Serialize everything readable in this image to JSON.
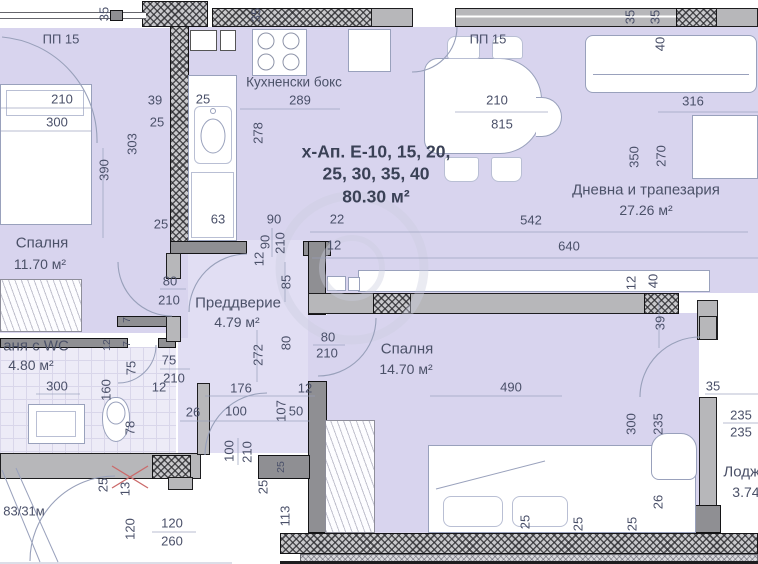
{
  "plan": {
    "title_block": {
      "x": 376,
      "lines": [
        {
          "t": "х-Ап. Е-10, 15, 20,",
          "y": 152
        },
        {
          "t": "25, 30, 35, 40",
          "y": 174
        },
        {
          "t": "80.30 м²",
          "y": 197
        }
      ]
    },
    "rooms": [
      {
        "name": "Спалня",
        "area": "11.70 м²",
        "nx": 42,
        "ny": 243,
        "ax": 40,
        "ay": 264
      },
      {
        "name": "Кухненски бокс",
        "area": null,
        "nx": 294,
        "ny": 82,
        "ns": 13.5
      },
      {
        "name": "Дневна и трапезария",
        "area": "27.26 м²",
        "nx": 646,
        "ny": 190,
        "ax": 646,
        "ay": 210
      },
      {
        "name": "Преддверие",
        "area": "4.79 м²",
        "nx": 238,
        "ny": 303,
        "ax": 237,
        "ay": 322
      },
      {
        "name": "аня с WC",
        "area": "4.80 м²",
        "nx": 36,
        "ny": 346,
        "ax": 31,
        "ay": 365
      },
      {
        "name": "Спалня",
        "area": "14.70 м²",
        "nx": 407,
        "ny": 349,
        "ax": 406,
        "ay": 369
      },
      {
        "name": "Лоджия",
        "area": "3.74 м²",
        "nx": 750,
        "ny": 472,
        "ax": 755,
        "ay": 492
      }
    ],
    "dimension_labels": [
      {
        "t": "35",
        "x": 104,
        "y": 14,
        "v": 1
      },
      {
        "t": "ПП 15",
        "x": 61,
        "y": 39,
        "s": 13
      },
      {
        "t": "210",
        "x": 62,
        "y": 99
      },
      {
        "t": "300",
        "x": 57,
        "y": 122
      },
      {
        "t": "390",
        "x": 104,
        "y": 170,
        "v": 1
      },
      {
        "t": "303",
        "x": 132,
        "y": 144,
        "v": 1
      },
      {
        "t": "39",
        "x": 155,
        "y": 100
      },
      {
        "t": "25",
        "x": 157,
        "y": 122
      },
      {
        "t": "25",
        "x": 203,
        "y": 99
      },
      {
        "t": "35",
        "x": 256,
        "y": 15,
        "v": 1
      },
      {
        "t": "289",
        "x": 300,
        "y": 100
      },
      {
        "t": "278",
        "x": 258,
        "y": 133,
        "v": 1
      },
      {
        "t": "25",
        "x": 161,
        "y": 224
      },
      {
        "t": "63",
        "x": 218,
        "y": 219
      },
      {
        "t": "90",
        "x": 274,
        "y": 219
      },
      {
        "t": "22",
        "x": 337,
        "y": 219
      },
      {
        "t": "90",
        "x": 265,
        "y": 242,
        "v": 1
      },
      {
        "t": "210",
        "x": 280,
        "y": 243,
        "v": 1
      },
      {
        "t": "12",
        "x": 334,
        "y": 245
      },
      {
        "t": "12",
        "x": 259,
        "y": 259,
        "v": 1
      },
      {
        "t": "85",
        "x": 286,
        "y": 282,
        "v": 1
      },
      {
        "t": "80",
        "x": 286,
        "y": 343,
        "v": 1
      },
      {
        "t": "272",
        "x": 258,
        "y": 355,
        "v": 1
      },
      {
        "t": "ПП 15",
        "x": 488,
        "y": 39,
        "s": 13
      },
      {
        "t": "210",
        "x": 497,
        "y": 100
      },
      {
        "t": "815",
        "x": 502,
        "y": 124
      },
      {
        "t": "35",
        "x": 630,
        "y": 17,
        "v": 1
      },
      {
        "t": "35",
        "x": 655,
        "y": 17,
        "v": 1
      },
      {
        "t": "40",
        "x": 660,
        "y": 44,
        "v": 1
      },
      {
        "t": "316",
        "x": 693,
        "y": 101
      },
      {
        "t": "350",
        "x": 634,
        "y": 157,
        "v": 1
      },
      {
        "t": "270",
        "x": 661,
        "y": 156,
        "v": 1
      },
      {
        "t": "542",
        "x": 531,
        "y": 220
      },
      {
        "t": "640",
        "x": 569,
        "y": 246
      },
      {
        "t": "80",
        "x": 170,
        "y": 281
      },
      {
        "t": "210",
        "x": 169,
        "y": 300
      },
      {
        "t": "7",
        "x": 127,
        "y": 320,
        "v": 1,
        "s": 10.5
      },
      {
        "t": "12",
        "x": 107,
        "y": 345,
        "v": 1,
        "s": 10.5
      },
      {
        "t": "7",
        "x": 127,
        "y": 344,
        "v": 1,
        "s": 10.5
      },
      {
        "t": "75",
        "x": 131,
        "y": 368,
        "v": 1
      },
      {
        "t": "160",
        "x": 106,
        "y": 390,
        "v": 1
      },
      {
        "t": "78",
        "x": 130,
        "y": 428,
        "v": 1
      },
      {
        "t": "75",
        "x": 169,
        "y": 360
      },
      {
        "t": "210",
        "x": 174,
        "y": 378
      },
      {
        "t": "12",
        "x": 159,
        "y": 387
      },
      {
        "t": "300",
        "x": 57,
        "y": 386
      },
      {
        "t": "80",
        "x": 328,
        "y": 337
      },
      {
        "t": "210",
        "x": 327,
        "y": 353
      },
      {
        "t": "12",
        "x": 631,
        "y": 283,
        "v": 1
      },
      {
        "t": "40",
        "x": 653,
        "y": 281,
        "v": 1
      },
      {
        "t": "39",
        "x": 660,
        "y": 323,
        "v": 1
      },
      {
        "t": "490",
        "x": 511,
        "y": 387
      },
      {
        "t": "176",
        "x": 241,
        "y": 388
      },
      {
        "t": "12",
        "x": 305,
        "y": 388
      },
      {
        "t": "26",
        "x": 193,
        "y": 412
      },
      {
        "t": "100",
        "x": 236,
        "y": 411
      },
      {
        "t": "50",
        "x": 296,
        "y": 411
      },
      {
        "t": "107",
        "x": 281,
        "y": 411,
        "v": 1
      },
      {
        "t": "100",
        "x": 229,
        "y": 451,
        "v": 1
      },
      {
        "t": "210",
        "x": 247,
        "y": 452,
        "v": 1
      },
      {
        "t": "25",
        "x": 281,
        "y": 467,
        "v": 1,
        "s": 10.5
      },
      {
        "t": "25",
        "x": 263,
        "y": 487,
        "v": 1
      },
      {
        "t": "113",
        "x": 285,
        "y": 516,
        "v": 1
      },
      {
        "t": "25",
        "x": 103,
        "y": 485,
        "v": 1
      },
      {
        "t": "13",
        "x": 125,
        "y": 489,
        "v": 1
      },
      {
        "t": "120",
        "x": 130,
        "y": 529,
        "v": 1
      },
      {
        "t": "120",
        "x": 172,
        "y": 523
      },
      {
        "t": "260",
        "x": 172,
        "y": 541
      },
      {
        "t": "83/31м",
        "x": 24,
        "y": 511,
        "s": 13
      },
      {
        "t": "35",
        "x": 713,
        "y": 386
      },
      {
        "t": "235",
        "x": 741,
        "y": 415
      },
      {
        "t": "235",
        "x": 741,
        "y": 432
      },
      {
        "t": "300",
        "x": 631,
        "y": 424,
        "v": 1
      },
      {
        "t": "235",
        "x": 658,
        "y": 424,
        "v": 1
      },
      {
        "t": "26",
        "x": 658,
        "y": 502,
        "v": 1
      },
      {
        "t": "25",
        "x": 525,
        "y": 522,
        "v": 1
      },
      {
        "t": "25",
        "x": 578,
        "y": 524,
        "v": 1
      },
      {
        "t": "25",
        "x": 632,
        "y": 524,
        "v": 1
      }
    ],
    "colors": {
      "floor": "#d8d4ee",
      "floor_light": "#e1def3",
      "wall_dark": "#8f8f93",
      "wall_gray": "#b7b7ba",
      "line": "#99a1bc",
      "text": "#4a5069",
      "title_text": "#3a4156",
      "marker_red": "#cb6a6a"
    }
  }
}
